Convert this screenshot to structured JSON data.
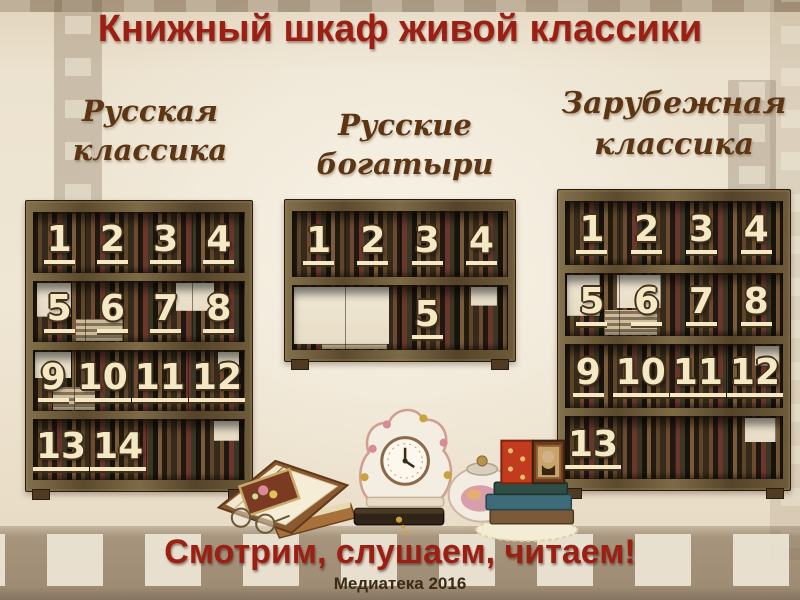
{
  "title": "Книжный шкаф живой классики",
  "bookcases": [
    {
      "id": "russian-classics",
      "label": [
        "Русская",
        "классика"
      ],
      "rows": [
        [
          "1",
          "2",
          "3",
          "4"
        ],
        [
          "5",
          "6",
          "7",
          "8"
        ],
        [
          "9",
          "10",
          "11",
          "12"
        ],
        [
          "13",
          "14",
          null,
          null
        ]
      ]
    },
    {
      "id": "russian-bogatyrs",
      "label": [
        "Русские",
        "богатыри"
      ],
      "rows": [
        [
          "1",
          "2",
          "3",
          "4"
        ],
        [
          null,
          null,
          "5",
          null
        ]
      ]
    },
    {
      "id": "foreign-classics",
      "label": [
        "Зарубежная",
        "классика"
      ],
      "rows": [
        [
          "1",
          "2",
          "3",
          "4"
        ],
        [
          "5",
          "6",
          "7",
          "8"
        ],
        [
          "9",
          "10",
          "11",
          "12"
        ],
        [
          "13",
          null,
          null,
          null
        ]
      ]
    }
  ],
  "footer": {
    "slogan": "Смотрим, слушаем, читаем!",
    "credit": "Медиатека 2016"
  },
  "decorative_illustration": "vintage still life: open book with reading glasses, porcelain clock, teapot, stacked books, folding icon portrait, lace doily",
  "colors": {
    "background": "#ece2cf",
    "title_red": "#9b1f13",
    "label_brown": "#5b3514",
    "number_cream": "#f4e9c4",
    "wood_brown": "#6e5b3a",
    "credit_brown": "#3b2a18"
  }
}
